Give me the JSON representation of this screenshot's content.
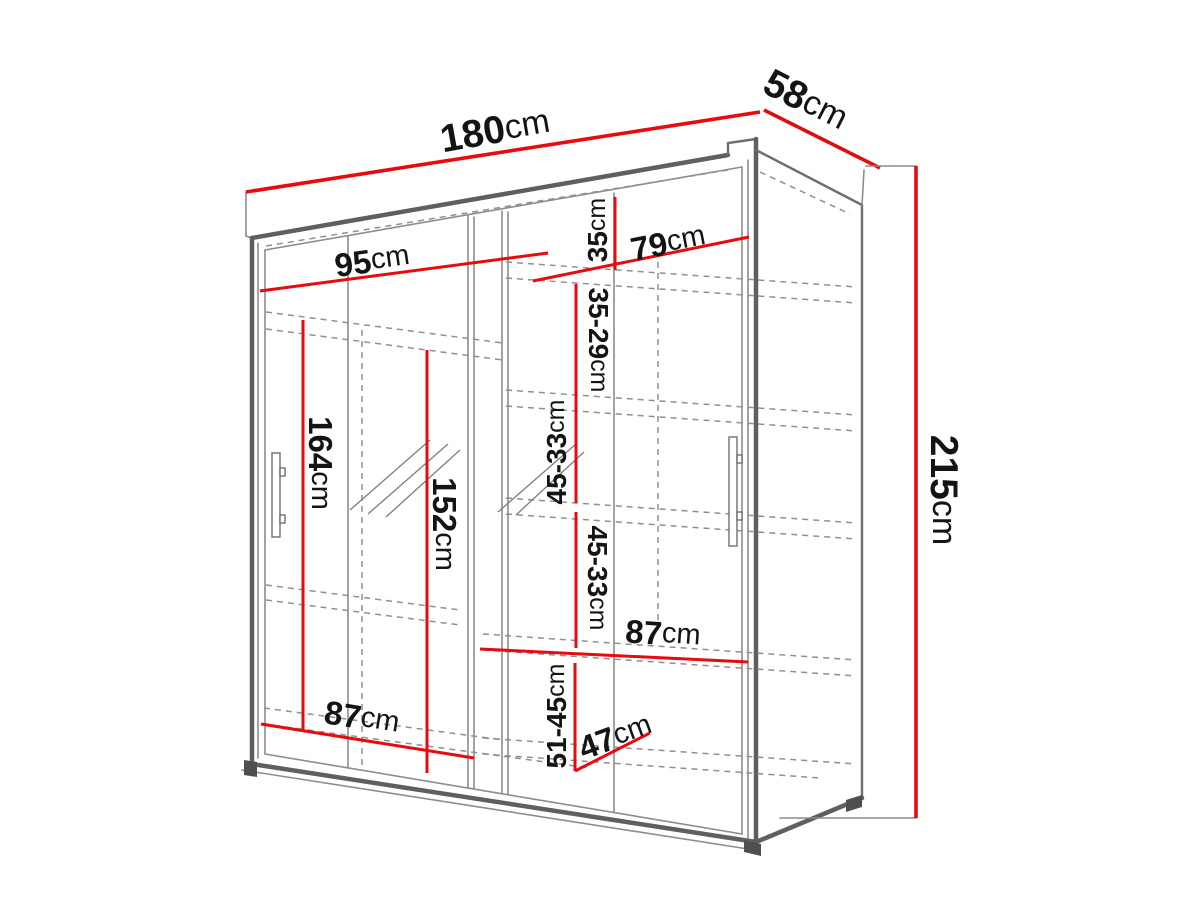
{
  "title": "Sliding wardrobe dimension diagram",
  "colors": {
    "dimension_red": "#e70a0e",
    "structure_gray": "#5f5f5f",
    "dashed_gray": "#909090",
    "label_black": "#141414",
    "background": "#ffffff"
  },
  "dims": {
    "total_width": {
      "num": "180",
      "unit": "cm"
    },
    "total_depth": {
      "num": "58",
      "unit": "cm"
    },
    "total_height": {
      "num": "215",
      "unit": "cm"
    },
    "left_inner_width": {
      "num": "95",
      "unit": "cm"
    },
    "right_inner_width": {
      "num": "79",
      "unit": "cm"
    },
    "right_top_gap": {
      "num": "35",
      "unit": "cm"
    },
    "right_gap_2": {
      "num": "35-29",
      "unit": "cm"
    },
    "right_gap_3": {
      "num": "45-33",
      "unit": "cm"
    },
    "right_gap_4": {
      "num": "45-33",
      "unit": "cm"
    },
    "right_shelf_width": {
      "num": "87",
      "unit": "cm"
    },
    "right_bottom_gap": {
      "num": "51-45",
      "unit": "cm"
    },
    "bottom_shelf_depth": {
      "num": "47",
      "unit": "cm"
    },
    "left_bottom_width": {
      "num": "87",
      "unit": "cm"
    },
    "left_hanging_height": {
      "num": "164",
      "unit": "cm"
    },
    "middle_hanging_height": {
      "num": "152",
      "unit": "cm"
    }
  }
}
